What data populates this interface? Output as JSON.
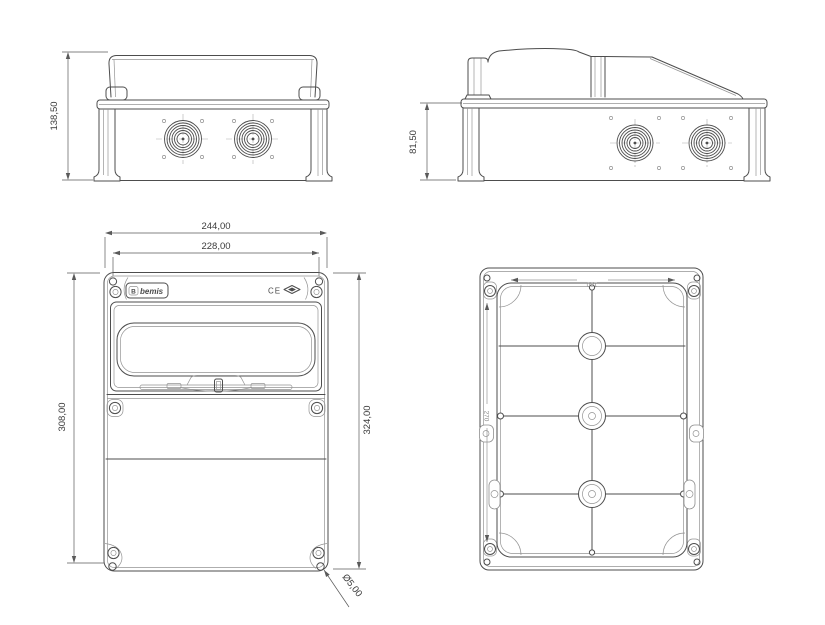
{
  "colors": {
    "line": "#4d4d4d",
    "background": "#ffffff"
  },
  "views": {
    "front_elevation": {
      "dim_height": "138,50"
    },
    "side_elevation": {
      "dim_height": "81,50"
    },
    "front_view": {
      "dim_width_flange": "244,00",
      "dim_width_lid": "228,00",
      "dim_height_mount": "308,00",
      "dim_height_overall": "324,00",
      "dim_mount_hole": "Ø5,00",
      "brand": "bemis",
      "brand_mark": "B",
      "ce": "CE"
    },
    "rear_view": {
      "molded_width": "180",
      "molded_height": "270"
    }
  }
}
